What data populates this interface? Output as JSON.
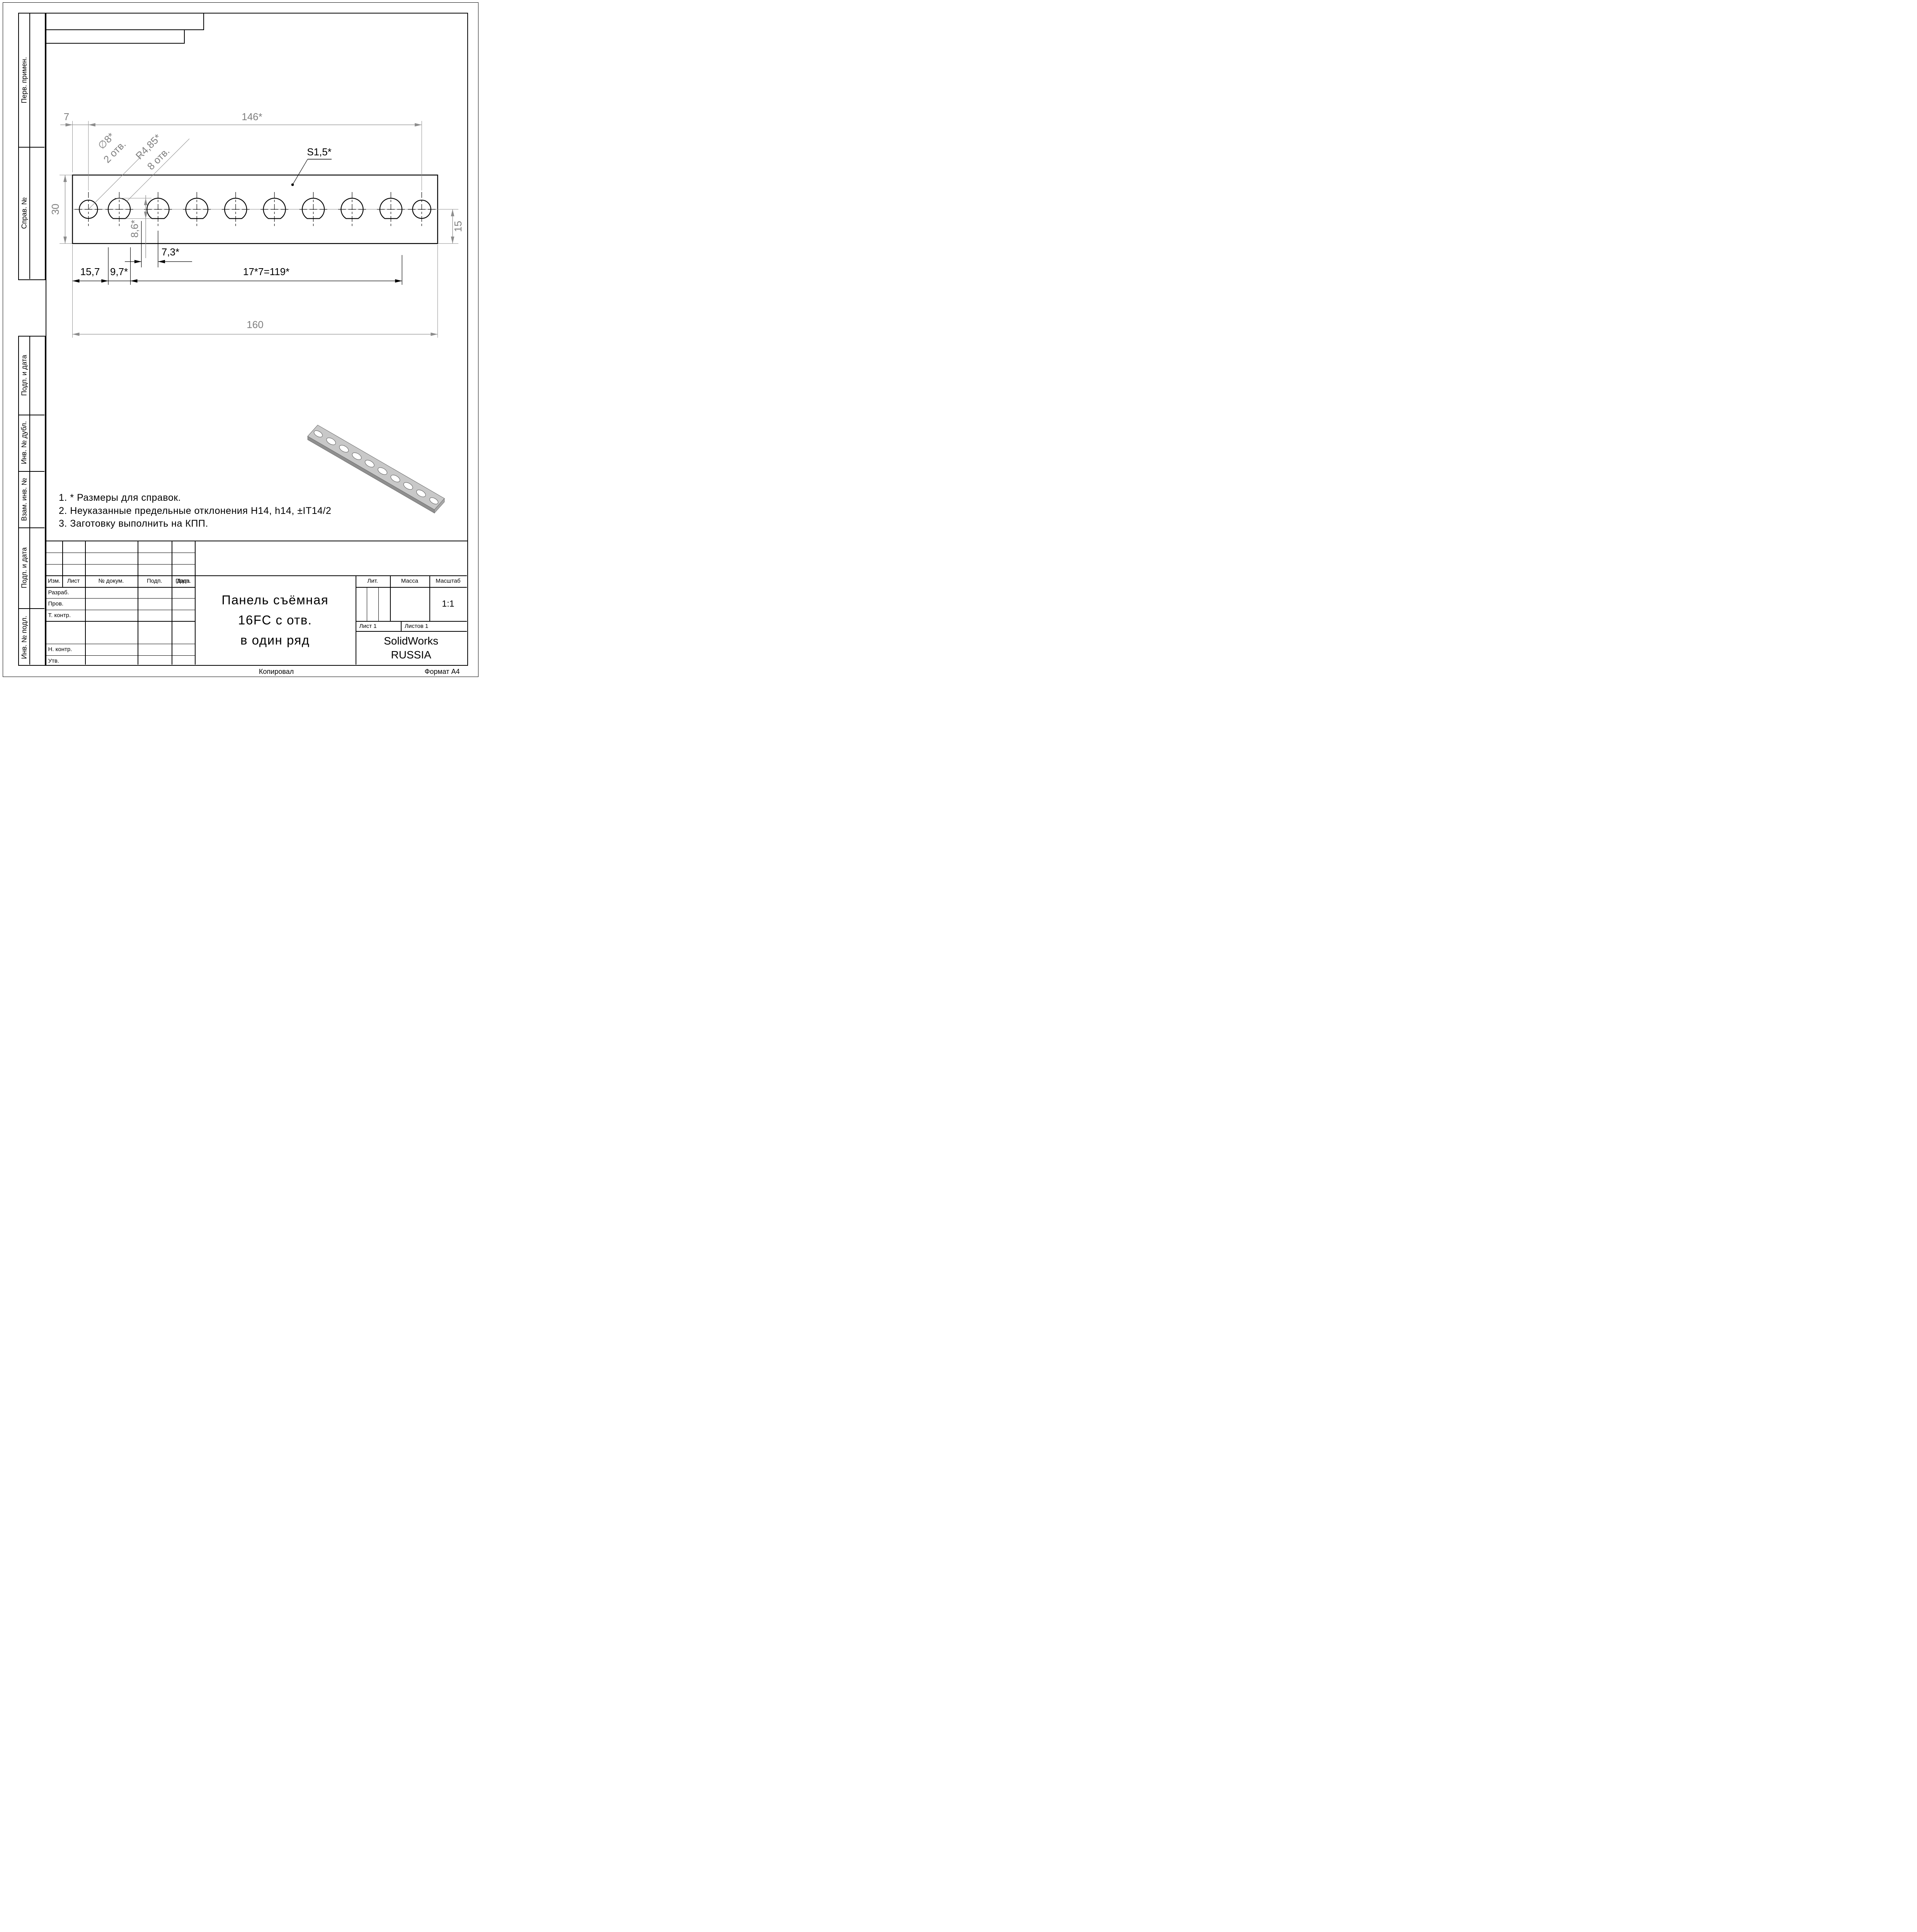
{
  "sheet": {
    "copied_label": "Копировал",
    "format_label": "Формат А4"
  },
  "sidebar": {
    "top": [
      {
        "label": "Перв. примен."
      },
      {
        "label": "Справ. №"
      }
    ],
    "bottom": [
      {
        "label": "Подп. и дата"
      },
      {
        "label": "Инв. № дубл."
      },
      {
        "label": "Взам. инв. №"
      },
      {
        "label": "Подп. и дата"
      },
      {
        "label": "Инв. № подл."
      }
    ]
  },
  "drawing": {
    "dims": {
      "edge_to_hole": "7",
      "holes_span": "146*",
      "height": "30",
      "end_height": "15",
      "hole_top": "8,6*",
      "flat_gap": "7,3*",
      "edge_left": "15,7",
      "tangent": "9,7*",
      "pitch": "17*7=119*",
      "total": "160"
    },
    "callouts": {
      "diameter": "∅8*",
      "diameter_qty": "2 отв.",
      "radius": "R4,85*",
      "radius_qty": "8 отв.",
      "thickness": "S1,5*"
    }
  },
  "notes": {
    "items": [
      "1. * Размеры для справок.",
      "2. Неуказанные предельные отклонения H14, h14, ±IT14/2",
      "3. Заготовку выполнить на КПП."
    ]
  },
  "title_block": {
    "header_cols": [
      "Изм.",
      "Лист",
      "№ докум.",
      "Подп.",
      "Дата"
    ],
    "approval_rows": [
      "Разраб.",
      "Пров.",
      "Т. контр.",
      "Н. контр.",
      "Утв."
    ],
    "title_lines": [
      "Панель съёмная",
      "16FC с отв.",
      "в один ряд"
    ],
    "lit_label": "Лит.",
    "mass_label": "Масса",
    "scale_label": "Масштаб",
    "scale_value": "1:1",
    "sheet_label": "Лист 1",
    "sheets_label": "Листов 1",
    "org_lines": [
      "SolidWorks",
      "RUSSIA"
    ]
  }
}
